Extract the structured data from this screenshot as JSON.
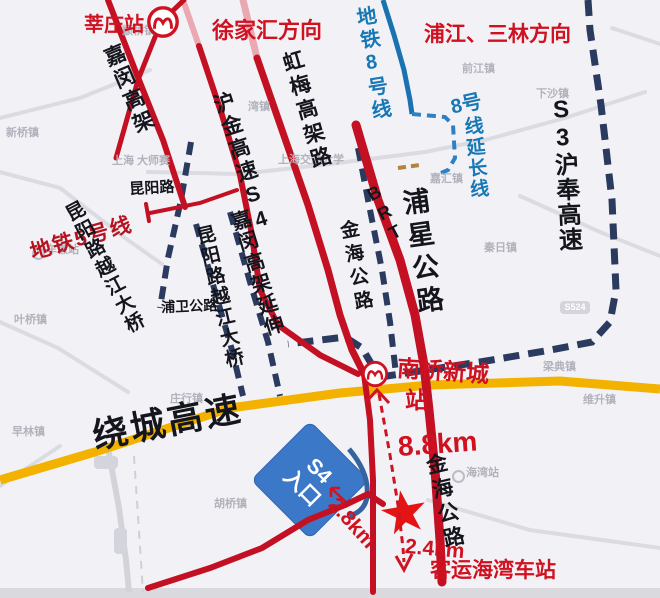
{
  "colors": {
    "road_red": "#c31022",
    "road_pink": "#eaa9b2",
    "expressway_yellow": "#f3b200",
    "planned_navy": "#2b3a5f",
    "metro8_blue": "#1a72b0",
    "metro8_ext_blue": "#2e80c4",
    "label_red": "#cf1120",
    "label_black": "#15151d",
    "label_blue": "#1878b6",
    "label_gray": "#b2b2bc",
    "sign_blue": "#3b78c8",
    "star_red": "#e41414"
  },
  "stations": {
    "xinzhuang": "莘庄站",
    "nanqiao_line1": "南桥新城",
    "nanqiao_line2": "站",
    "haiwan_bus": "客运海湾车站"
  },
  "directions": {
    "xujiahui": "徐家汇方向",
    "pujiang_sanlin": "浦江、三林方向"
  },
  "metro": {
    "line8": "地铁8号线",
    "line8_ext_head": "8号",
    "line8_ext_tail": "线延长线",
    "line5": "地铁5号线",
    "brt": "BRT"
  },
  "roads": {
    "jiamin": "嘉闵高架",
    "hujin_s4": "沪金高速S4",
    "hongmei": "虹梅高架路",
    "s3_hufeng": "S3沪奉高速",
    "kunyang": "昆阳路",
    "kunyang_bridge_west": "昆阳路越江大桥",
    "kunyang_bridge_east": "昆阳路越江大桥",
    "puwei": "浦卫公路",
    "jiamin_ext": "嘉闵高架延伸",
    "jinhai_north": "金海公路",
    "puxing": "浦星公路",
    "raocheng": "绕城高速",
    "jinhai_south": "金海公路"
  },
  "sign": {
    "line1": "S4",
    "line2": "入口"
  },
  "distances": {
    "to_nanqiao": "8.8km",
    "to_s4": "2.8km",
    "to_haiwan": "2.4km"
  },
  "marker": {
    "star": "★"
  },
  "bg_labels": [
    {
      "text": "新桥镇"
    },
    {
      "text": "颛桥镇"
    },
    {
      "text": "上海 大师赛"
    },
    {
      "text": "车墩站"
    },
    {
      "text": "湾镇"
    },
    {
      "text": "上海交通大学"
    },
    {
      "text": "前江镇"
    },
    {
      "text": "下沙镇"
    },
    {
      "text": "嘉汇镇"
    },
    {
      "text": "秦日镇"
    },
    {
      "text": "梁典镇"
    },
    {
      "text": "维升镇"
    },
    {
      "text": "叶桥镇"
    },
    {
      "text": "早林镇"
    },
    {
      "text": "庄行镇"
    },
    {
      "text": "胡桥镇"
    },
    {
      "text": "海湾站"
    },
    {
      "text": "S524"
    }
  ]
}
